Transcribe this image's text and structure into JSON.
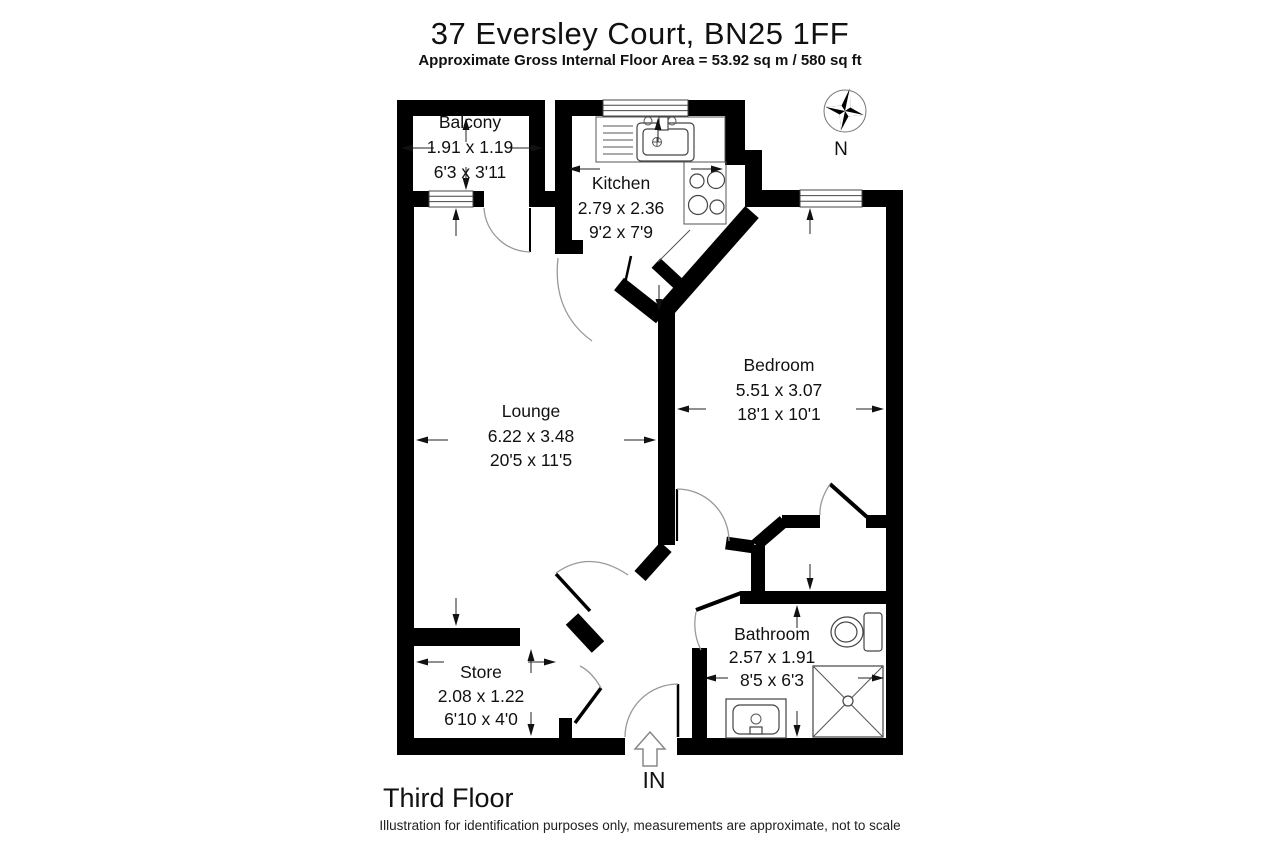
{
  "title": "37 Eversley Court, BN25 1FF",
  "subtitle": "Approximate Gross Internal Floor Area = 53.92 sq m / 580 sq ft",
  "floor_label": "Third Floor",
  "disclaimer": "Illustration for identification purposes only, measurements are approximate, not to scale",
  "entrance_label": "IN",
  "compass_label": "N",
  "rooms": {
    "balcony": {
      "name": "Balcony",
      "metric": "1.91 x 1.19",
      "imperial": "6'3 x 3'11"
    },
    "kitchen": {
      "name": "Kitchen",
      "metric": "2.79 x 2.36",
      "imperial": "9'2 x 7'9"
    },
    "bedroom": {
      "name": "Bedroom",
      "metric": "5.51 x 3.07",
      "imperial": "18'1 x 10'1"
    },
    "lounge": {
      "name": "Lounge",
      "metric": "6.22 x 3.48",
      "imperial": "20'5 x 11'5"
    },
    "store": {
      "name": "Store",
      "metric": "2.08 x 1.22",
      "imperial": "6'10 x 4'0"
    },
    "bathroom": {
      "name": "Bathroom",
      "metric": "2.57 x 1.91",
      "imperial": "8'5 x 6'3"
    }
  },
  "colors": {
    "walls": "#000000",
    "text": "#111111",
    "door_arc": "#999999",
    "fixtures": "#444444"
  }
}
